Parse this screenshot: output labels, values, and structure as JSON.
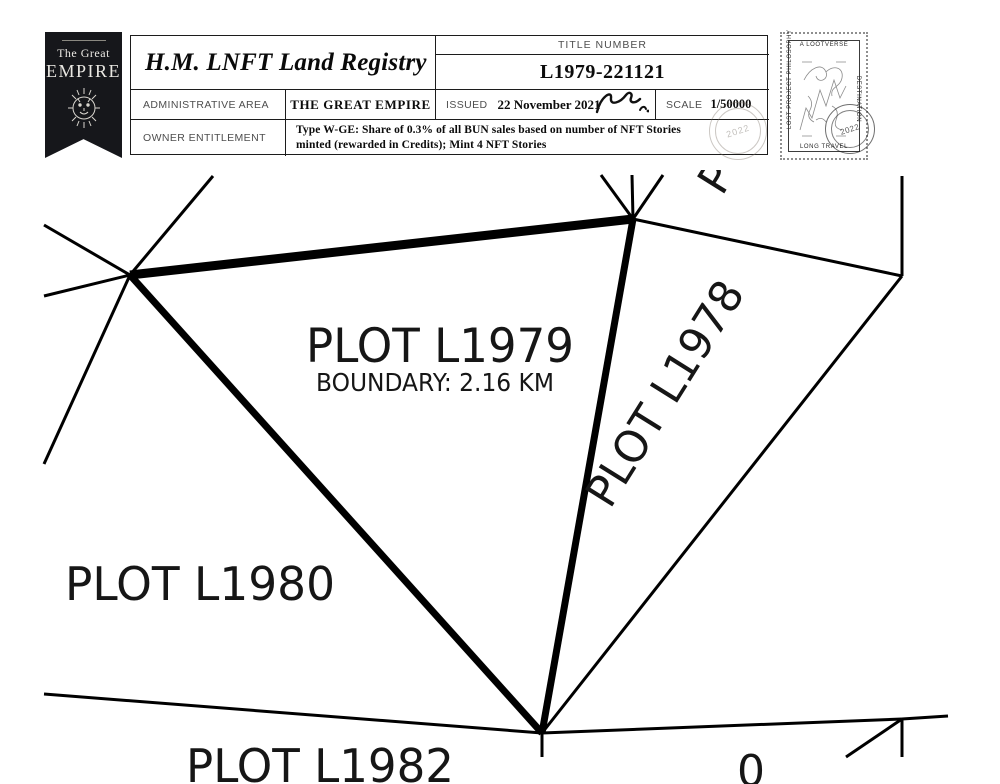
{
  "certificate": {
    "badge": {
      "line1": "The Great",
      "line2": "EMPIRE"
    },
    "title": "H.M. LNFT Land Registry",
    "title_number_label": "TITLE NUMBER",
    "title_number": "L1979-221121",
    "admin_area_label": "ADMINISTRATIVE AREA",
    "admin_area_value": "THE GREAT EMPIRE",
    "issued_label": "ISSUED",
    "issued_value": "22 November 2021",
    "scale_label": "SCALE",
    "scale_value": "1/50000",
    "owner_label": "OWNER ENTITLEMENT",
    "owner_value": "Type W-GE: Share of 0.3% of all BUN sales based on number of NFT Stories minted (rewarded in Credits); Mint 4 NFT Stories",
    "seal_text": "2022"
  },
  "stamp": {
    "top_text": "A LOOTVERSE",
    "right_text": "DESTINATION",
    "left_text": "LOST PROJECT PHILOSOPHY",
    "bottom_text": "LONG TRAVEL",
    "postmark_text": "2022"
  },
  "map": {
    "plot_label": "PLOT L1979",
    "plot_boundary": "BOUNDARY: 2.16 KM",
    "plot_left": "PLOT L1980",
    "plot_right": "PLOT L1978",
    "plot_bottom": "PLOT L1982",
    "plot_partial_top": "P",
    "plot_partial_bottom": "0"
  },
  "colors": {
    "line": "#000000",
    "paper": "#ffffff",
    "label_gray": "#4e4e4e"
  }
}
